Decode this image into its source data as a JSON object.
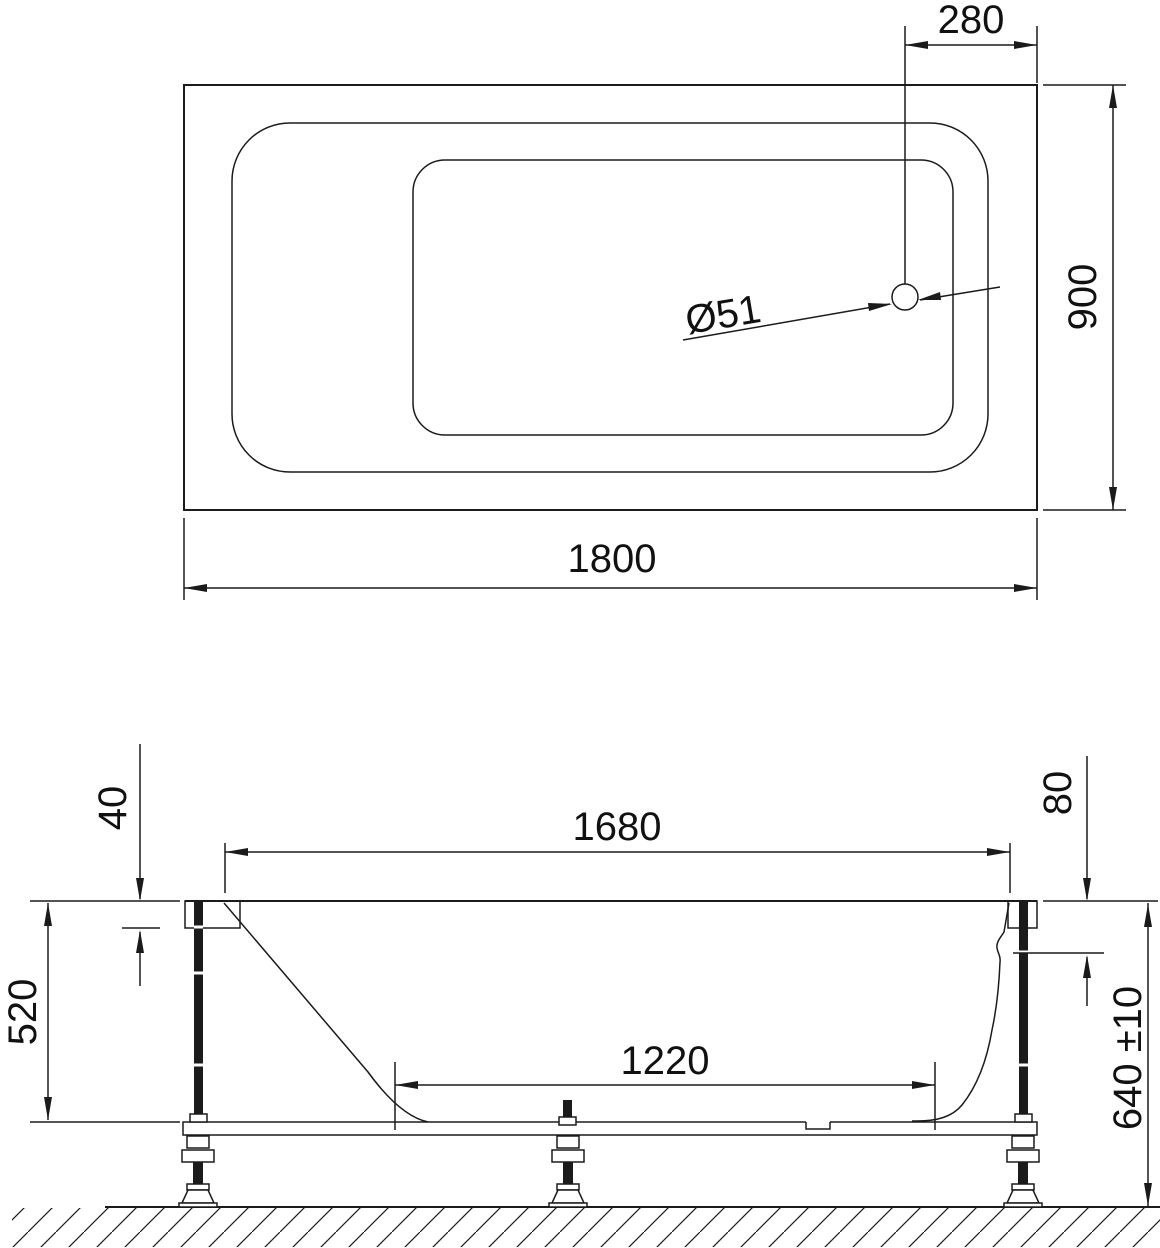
{
  "colors": {
    "background": "#ffffff",
    "line": "#1b1b1b",
    "text": "#111111"
  },
  "top_view": {
    "dim_length": "1800",
    "dim_width": "900",
    "dim_drain_offset": "280",
    "dim_drain_diameter": "Ø51"
  },
  "side_view": {
    "dim_inner_top_length": "1680",
    "dim_bottom_length": "1220",
    "dim_rim_thickness": "40",
    "dim_apron_depth": "80",
    "dim_shell_height": "520",
    "dim_overall_height": "640 ±10"
  }
}
